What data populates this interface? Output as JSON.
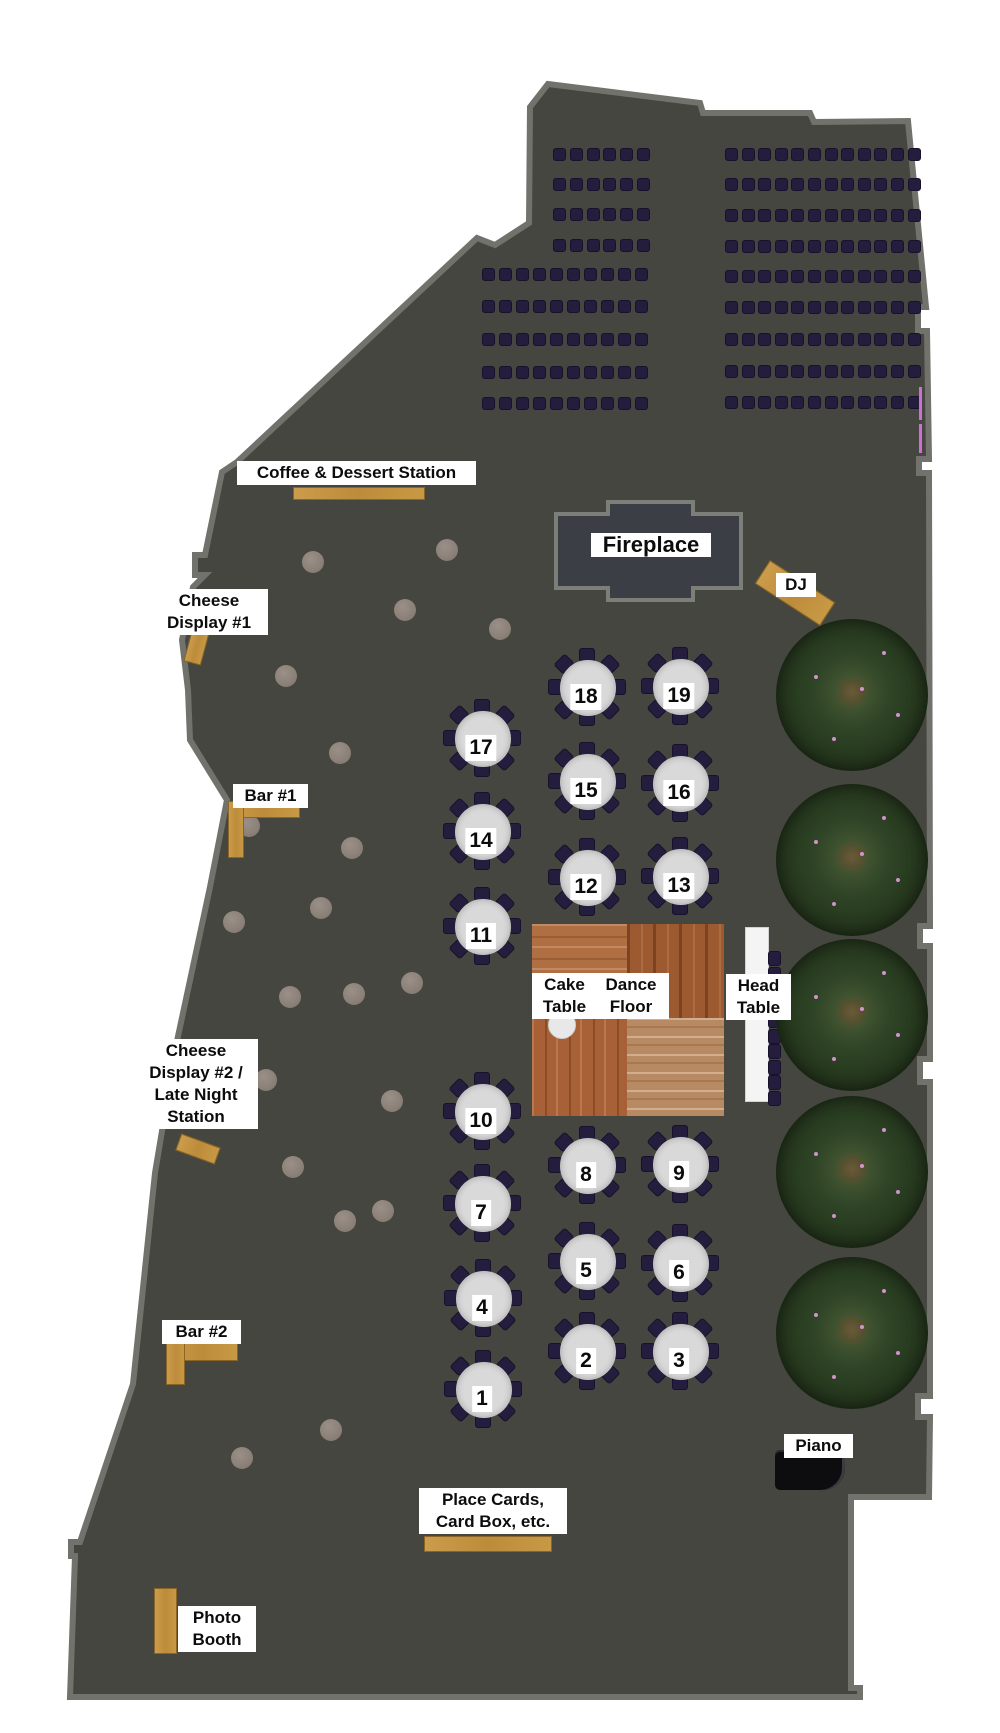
{
  "page": {
    "title": "Wedding Reception Floor Plan"
  },
  "colors": {
    "floor": "#45463f",
    "wall": "#71726b",
    "fireplace_fill": "#3b3e45",
    "fireplace_border": "#7c7e78",
    "chair": "#241d3e",
    "table_disc": "#d9d9d9",
    "station_wood": "#c1923f",
    "head_table": "#f4f4f4",
    "piano": "#0d0d10",
    "pillar": "#8d8279",
    "tree_green": "#2c3f22",
    "pink_accent": "#cf6fd6",
    "label_bg": "#ffffff",
    "label_text": "#0c0c0c"
  },
  "outline": [
    [
      548,
      84
    ],
    [
      700,
      103
    ],
    [
      703,
      113
    ],
    [
      810,
      113
    ],
    [
      814,
      122
    ],
    [
      908,
      121
    ],
    [
      926,
      307
    ],
    [
      918,
      307
    ],
    [
      918,
      331
    ],
    [
      927,
      331
    ],
    [
      929,
      459
    ],
    [
      919,
      459
    ],
    [
      919,
      473
    ],
    [
      929,
      473
    ],
    [
      930,
      926
    ],
    [
      920,
      926
    ],
    [
      920,
      946
    ],
    [
      930,
      946
    ],
    [
      930,
      1059
    ],
    [
      920,
      1059
    ],
    [
      920,
      1082
    ],
    [
      930,
      1082
    ],
    [
      930,
      1396
    ],
    [
      918,
      1396
    ],
    [
      918,
      1417
    ],
    [
      930,
      1417
    ],
    [
      929,
      1497
    ],
    [
      851,
      1497
    ],
    [
      851,
      1688
    ],
    [
      860,
      1688
    ],
    [
      860,
      1697
    ],
    [
      70,
      1697
    ],
    [
      75,
      1556
    ],
    [
      71,
      1556
    ],
    [
      71,
      1542
    ],
    [
      80,
      1542
    ],
    [
      133,
      1384
    ],
    [
      155,
      1173
    ],
    [
      177,
      1041
    ],
    [
      210,
      887
    ],
    [
      227,
      800
    ],
    [
      190,
      740
    ],
    [
      188,
      690
    ],
    [
      182,
      640
    ],
    [
      193,
      587
    ],
    [
      205,
      575
    ],
    [
      195,
      575
    ],
    [
      195,
      555
    ],
    [
      205,
      555
    ],
    [
      222,
      472
    ],
    [
      237,
      462
    ],
    [
      477,
      238
    ],
    [
      495,
      245
    ],
    [
      529,
      223
    ],
    [
      530,
      107
    ]
  ],
  "ceremony_rows": [
    {
      "name": "left-block-short",
      "x0": 553,
      "dx": 16.8,
      "n": 6,
      "ys": [
        148,
        178,
        208,
        239
      ]
    },
    {
      "name": "left-block-long",
      "x0": 482,
      "dx": 17.0,
      "n": 10,
      "ys": [
        268,
        300,
        333,
        366,
        397
      ]
    },
    {
      "name": "right-block",
      "x0": 725,
      "dx": 16.6,
      "n": 12,
      "ys": [
        148,
        178,
        209,
        240,
        270,
        301,
        333,
        365,
        396
      ]
    }
  ],
  "chair_size": {
    "w": 11,
    "h": 11
  },
  "fireplace": {
    "path": "M608,502 L693,502 L693,514 L741,514 L741,588 L693,588 L693,600 L608,600 L608,588 L556,588 L556,514 L608,514 Z",
    "label": "Fireplace"
  },
  "dance_floor": {
    "x": 532,
    "y": 924,
    "w": 192,
    "h": 192,
    "split_x": 627,
    "split_y": 1018
  },
  "cake_circle": {
    "cx": 561,
    "cy": 1024,
    "r": 13
  },
  "head_table": {
    "x": 745,
    "y": 927,
    "w": 22,
    "h": 173,
    "chairs": {
      "x": 768,
      "y0": 951,
      "dy": 15.5,
      "n": 10,
      "w": 11,
      "h": 13
    }
  },
  "piano": {
    "x": 775,
    "y": 1450,
    "w": 70,
    "h": 40
  },
  "pink_marks": [
    {
      "x": 919,
      "y": 387,
      "w": 3,
      "h": 33
    },
    {
      "x": 919,
      "y": 424,
      "w": 3,
      "h": 29
    }
  ],
  "trees": {
    "cx": 852,
    "r": 76,
    "ys": [
      695,
      860,
      1015,
      1172,
      1333
    ],
    "specks": [
      [
        -38,
        -20
      ],
      [
        30,
        -44
      ],
      [
        44,
        18
      ],
      [
        -20,
        42
      ],
      [
        8,
        -8
      ]
    ]
  },
  "pillars": {
    "r": 11,
    "centers": [
      [
        313,
        562
      ],
      [
        447,
        550
      ],
      [
        405,
        610
      ],
      [
        500,
        629
      ],
      [
        286,
        676
      ],
      [
        340,
        753
      ],
      [
        249,
        826
      ],
      [
        352,
        848
      ],
      [
        321,
        908
      ],
      [
        234,
        922
      ],
      [
        290,
        997
      ],
      [
        412,
        983
      ],
      [
        354,
        994
      ],
      [
        266,
        1080
      ],
      [
        392,
        1101
      ],
      [
        293,
        1167
      ],
      [
        345,
        1221
      ],
      [
        383,
        1211
      ],
      [
        331,
        1430
      ],
      [
        242,
        1458
      ]
    ]
  },
  "tables": {
    "disc_r": 26,
    "chair_ring_r": 32,
    "chair_w": 14,
    "chair_h": 12,
    "chairs_per_table": 8,
    "items": [
      {
        "number": "18",
        "cx": 586,
        "cy": 686
      },
      {
        "number": "19",
        "cx": 679,
        "cy": 685
      },
      {
        "number": "17",
        "cx": 481,
        "cy": 737
      },
      {
        "number": "15",
        "cx": 586,
        "cy": 780
      },
      {
        "number": "16",
        "cx": 679,
        "cy": 782
      },
      {
        "number": "14",
        "cx": 481,
        "cy": 830
      },
      {
        "number": "12",
        "cx": 586,
        "cy": 876
      },
      {
        "number": "13",
        "cx": 679,
        "cy": 875
      },
      {
        "number": "11",
        "cx": 481,
        "cy": 925
      },
      {
        "number": "10",
        "cx": 481,
        "cy": 1110
      },
      {
        "number": "8",
        "cx": 586,
        "cy": 1164
      },
      {
        "number": "9",
        "cx": 679,
        "cy": 1163
      },
      {
        "number": "7",
        "cx": 481,
        "cy": 1202
      },
      {
        "number": "5",
        "cx": 586,
        "cy": 1260
      },
      {
        "number": "6",
        "cx": 679,
        "cy": 1262
      },
      {
        "number": "4",
        "cx": 482,
        "cy": 1297
      },
      {
        "number": "2",
        "cx": 586,
        "cy": 1350
      },
      {
        "number": "3",
        "cx": 679,
        "cy": 1350
      },
      {
        "number": "1",
        "cx": 482,
        "cy": 1388
      }
    ]
  },
  "stations": [
    {
      "id": "coffee-dessert-table",
      "x": 293,
      "y": 487,
      "w": 130,
      "h": 11,
      "rot": 0
    },
    {
      "id": "cheese-display-1-table",
      "x": 188,
      "y": 626,
      "w": 16,
      "h": 36,
      "rot": 15
    },
    {
      "id": "bar-1-counter-top",
      "x": 228,
      "y": 801,
      "w": 70,
      "h": 15,
      "rot": 0
    },
    {
      "id": "bar-1-counter-side",
      "x": 228,
      "y": 801,
      "w": 14,
      "h": 55,
      "rot": 0
    },
    {
      "id": "dj-table",
      "x": 756,
      "y": 579,
      "w": 76,
      "h": 26,
      "rot": 33
    },
    {
      "id": "cheese-display-2-table",
      "x": 177,
      "y": 1140,
      "w": 40,
      "h": 16,
      "rot": 20
    },
    {
      "id": "bar-2-counter-top",
      "x": 166,
      "y": 1343,
      "w": 70,
      "h": 16,
      "rot": 0
    },
    {
      "id": "bar-2-counter-side",
      "x": 166,
      "y": 1343,
      "w": 17,
      "h": 40,
      "rot": 0
    },
    {
      "id": "place-cards-table",
      "x": 424,
      "y": 1536,
      "w": 126,
      "h": 14,
      "rot": 0
    },
    {
      "id": "photo-booth-unit",
      "x": 154,
      "y": 1588,
      "w": 21,
      "h": 64,
      "rot": 0
    }
  ],
  "labels": [
    {
      "id": "coffee-dessert",
      "x": 237,
      "y": 461,
      "w": 233,
      "lines": [
        "Coffee & Dessert Station"
      ],
      "size": 17
    },
    {
      "id": "cheese-display-1",
      "x": 150,
      "y": 589,
      "w": 112,
      "lines": [
        "Cheese",
        "Display #1"
      ],
      "size": 17
    },
    {
      "id": "bar-1",
      "x": 233,
      "y": 784,
      "w": 69,
      "lines": [
        "Bar #1"
      ],
      "size": 17
    },
    {
      "id": "fireplace",
      "x": 591,
      "y": 533,
      "w": 114,
      "lines": [
        "Fireplace"
      ],
      "size": 22
    },
    {
      "id": "dj",
      "x": 776,
      "y": 573,
      "w": 34,
      "lines": [
        "DJ"
      ],
      "size": 17
    },
    {
      "id": "cheese-display-2",
      "x": 134,
      "y": 1039,
      "w": 118,
      "lines": [
        "Cheese",
        "Display #2 /",
        "Late Night",
        "Station"
      ],
      "size": 17
    },
    {
      "id": "bar-2",
      "x": 162,
      "y": 1320,
      "w": 73,
      "lines": [
        "Bar #2"
      ],
      "size": 17
    },
    {
      "id": "cake-table",
      "x": 532,
      "y": 973,
      "w": 59,
      "lines": [
        "Cake",
        "Table"
      ],
      "size": 17
    },
    {
      "id": "dance-floor",
      "x": 593,
      "y": 973,
      "w": 70,
      "lines": [
        "Dance",
        "Floor"
      ],
      "size": 17
    },
    {
      "id": "head-table",
      "x": 726,
      "y": 974,
      "w": 59,
      "lines": [
        "Head",
        "Table"
      ],
      "size": 17
    },
    {
      "id": "piano",
      "x": 784,
      "y": 1434,
      "w": 63,
      "lines": [
        "Piano"
      ],
      "size": 17
    },
    {
      "id": "place-cards",
      "x": 419,
      "y": 1488,
      "w": 142,
      "lines": [
        "Place Cards,",
        "Card Box, etc."
      ],
      "size": 17
    },
    {
      "id": "photo-booth",
      "x": 178,
      "y": 1606,
      "w": 72,
      "lines": [
        "Photo",
        "Booth"
      ],
      "size": 17
    }
  ]
}
